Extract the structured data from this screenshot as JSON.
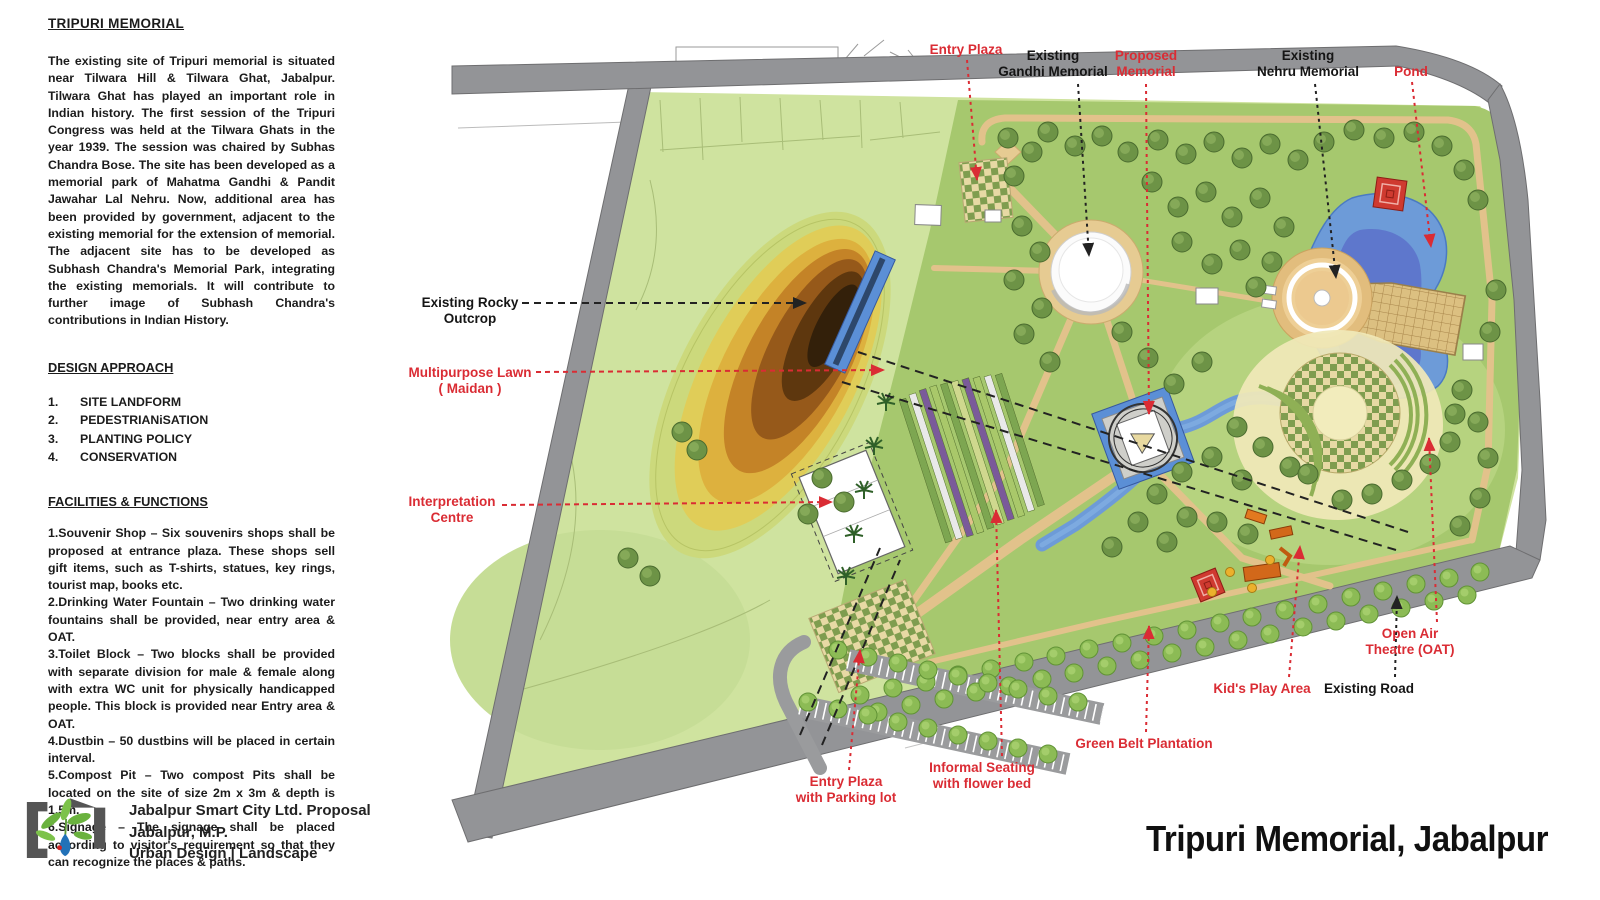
{
  "panel": {
    "title": "TRIPURI MEMORIAL",
    "intro": "The existing site of Tripuri memorial is situated near Tilwara Hill & Tilwara Ghat, Jabalpur. Tilwara Ghat has played an important role in Indian history. The first session of the Tripuri Congress was held at the Tilwara Ghats in the year 1939. The session was chaired by Subhas Chandra Bose. The site has been developed as a memorial park of Mahatma Gandhi & Pandit Jawahar Lal Nehru. Now, additional area has been provided by government, adjacent to the existing memorial for the extension of memorial. The adjacent site has to be developed as Subhash Chandra's Memorial Park, integrating the existing memorials. It will contribute to further image of Subhash Chandra's contributions in Indian History.",
    "design_approach": {
      "heading": "DESIGN APPROACH",
      "items": [
        "SITE LANDFORM",
        "PEDESTRIANiSATION",
        "PLANTING POLICY",
        "CONSERVATION"
      ]
    },
    "facilities": {
      "heading": "FACILITIES & FUNCTIONS",
      "items": [
        "1.Souvenir Shop – Six souvenirs shops shall be proposed at entrance plaza. These shops sell gift items, such as T-shirts, statues, key rings, tourist map, books etc.",
        "2.Drinking Water Fountain – Two drinking water fountains shall be provided, near entry area & OAT.",
        "3.Toilet Block – Two blocks shall be provided with separate division for male & female along with extra WC unit for physically handicapped people. This block is provided near Entry area & OAT.",
        "4.Dustbin – 50 dustbins will be placed in certain interval.",
        "5.Compost Pit – Two compost Pits shall be located on the site of size 2m x 3m & depth is 1.5m.",
        "6.Signage – The signage shall be placed according to visitor's requirement so that they can recognize the places & paths."
      ]
    }
  },
  "footer": {
    "org": "Jabalpur Smart City Ltd. Proposal",
    "city": "Jabalpur, M.P.",
    "dept": "Urban Design | Landscape"
  },
  "plan": {
    "title": "Tripuri Memorial, Jabalpur",
    "labels": [
      {
        "name": "entry-plaza-top",
        "color": "red",
        "lines": [
          "Entry Plaza"
        ]
      },
      {
        "name": "gandhi-memorial",
        "color": "black",
        "lines": [
          "Existing",
          "Gandhi Memorial"
        ]
      },
      {
        "name": "proposed-memorial",
        "color": "red",
        "lines": [
          "Proposed",
          "Memorial"
        ]
      },
      {
        "name": "nehru-memorial",
        "color": "black",
        "lines": [
          "Existing",
          "Nehru Memorial"
        ]
      },
      {
        "name": "pond",
        "color": "red",
        "lines": [
          "Pond"
        ]
      },
      {
        "name": "rocky-outcrop",
        "color": "black",
        "lines": [
          "Existing Rocky",
          "Outcrop"
        ]
      },
      {
        "name": "multipurpose-lawn",
        "color": "red",
        "lines": [
          "Multipurpose Lawn",
          "( Maidan )"
        ]
      },
      {
        "name": "interpretation-centre",
        "color": "red",
        "lines": [
          "Interpretation",
          "Centre"
        ]
      },
      {
        "name": "kids-play-area",
        "color": "red",
        "lines": [
          "Kid's Play Area"
        ]
      },
      {
        "name": "existing-road",
        "color": "black",
        "lines": [
          "Existing Road"
        ]
      },
      {
        "name": "open-air-theatre",
        "color": "red",
        "lines": [
          "Open Air",
          "Theatre (OAT)"
        ]
      },
      {
        "name": "green-belt",
        "color": "red",
        "lines": [
          "Green Belt Plantation"
        ]
      },
      {
        "name": "informal-seating",
        "color": "red",
        "lines": [
          "Informal Seating",
          "with flower bed"
        ]
      },
      {
        "name": "entry-plaza-bottom",
        "color": "red",
        "lines": [
          "Entry Plaza",
          "with Parking lot"
        ]
      }
    ]
  },
  "colors": {
    "label_red": "#da2c34",
    "road_gray": "#939497",
    "maidan_green": "#cfe39f",
    "park_green": "#a6c86e",
    "water_blue": "#6d9bd8",
    "path_tan": "#e2c28b"
  }
}
